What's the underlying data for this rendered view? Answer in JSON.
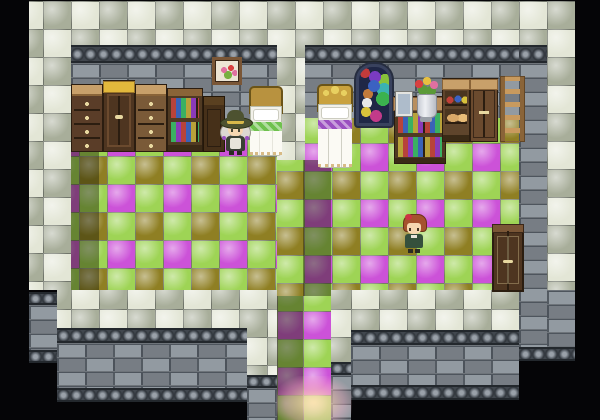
{
  "meta": {
    "title": "rpg-interior-map",
    "width": 600,
    "height": 420,
    "background": "#050507"
  },
  "palette": {
    "checker_light": "#e3e6d6",
    "checker_dark": "#a8ae9a",
    "grout": "#70756a",
    "floor_green": "#9ed455",
    "floor_magenta": "#cc52d8",
    "floor_olive": "#8f7f23",
    "brick": "#8a929a",
    "mortar": "#4e555d",
    "carved": "#41474e",
    "wood_dark": "#4e3520",
    "wood_mid": "#6b4a2e",
    "wood_tan": "#c8a06a",
    "yellow_top": "#e2b83c",
    "glow": "#ffdcaa",
    "book_colors": [
      "#b8433a",
      "#3a62b8",
      "#3ab062",
      "#b8a23a",
      "#8a3ab8"
    ],
    "jar_colors": [
      "#c04038",
      "#3b62c2",
      "#d8c23b"
    ],
    "window_colors": [
      "#c23b3b",
      "#3b62c2",
      "#3bb24e",
      "#d8c23b",
      "#7a3bc2",
      "#3bb2b2",
      "#e8e8e8",
      "#c23b8a",
      "#88c23b",
      "#c27a3b"
    ]
  },
  "regions": [
    {
      "name": "border-top-checker",
      "pattern": "checker",
      "x": 29,
      "y": 1,
      "w": 546,
      "h": 44,
      "ph": [
        42,
        0
      ],
      "interactable": false
    },
    {
      "name": "border-left-checker",
      "pattern": "checker",
      "x": 29,
      "y": 45,
      "w": 42,
      "h": 245,
      "ph": [
        42,
        12
      ],
      "interactable": false
    },
    {
      "name": "border-right-checker",
      "pattern": "checker",
      "x": 547,
      "y": 45,
      "w": 28,
      "h": 245,
      "ph": [
        28,
        12
      ],
      "interactable": false
    },
    {
      "name": "wall-cap-left-room",
      "pattern": "carved",
      "x": 71,
      "y": 45,
      "w": 206,
      "h": 18,
      "interactable": false
    },
    {
      "name": "wall-cap-right-room",
      "pattern": "carved",
      "x": 303,
      "y": 45,
      "w": 216,
      "h": 18,
      "interactable": false
    },
    {
      "name": "wall-cap-east",
      "pattern": "carved",
      "x": 519,
      "y": 45,
      "w": 28,
      "h": 18,
      "interactable": false
    },
    {
      "name": "wall-brick-left-room",
      "pattern": "brick",
      "x": 71,
      "y": 63,
      "w": 206,
      "h": 77,
      "interactable": false
    },
    {
      "name": "wall-brick-right-room",
      "pattern": "brick",
      "x": 303,
      "y": 63,
      "w": 216,
      "h": 55,
      "interactable": false
    },
    {
      "name": "wall-brick-east",
      "pattern": "brick",
      "x": 519,
      "y": 63,
      "w": 28,
      "h": 284,
      "interactable": false
    },
    {
      "name": "floor-left-room",
      "pattern": "floor",
      "x": 71,
      "y": 140,
      "w": 206,
      "h": 156,
      "ph": [
        36,
        44
      ],
      "interactable": true
    },
    {
      "name": "floor-left-wall-shadow",
      "pattern": "shade",
      "x": 71,
      "y": 140,
      "w": 28,
      "h": 156,
      "interactable": false
    },
    {
      "name": "floor-right-room",
      "pattern": "floor",
      "x": 277,
      "y": 118,
      "w": 242,
      "h": 178,
      "ph": [
        27,
        25
      ],
      "interactable": true
    },
    {
      "name": "floor-right-wall-shadow",
      "pattern": "shade",
      "x": 303,
      "y": 160,
      "w": 28,
      "h": 136,
      "interactable": false
    },
    {
      "name": "divider-wall-checker",
      "pattern": "checker",
      "x": 277,
      "y": 45,
      "w": 28,
      "h": 115,
      "ph": [
        18,
        12
      ],
      "interactable": false
    },
    {
      "name": "corridor-floor-shadowed",
      "pattern": "floor",
      "x": 277,
      "y": 296,
      "w": 26,
      "h": 124,
      "ph": [
        0,
        15
      ],
      "interactable": true
    },
    {
      "name": "corridor-shadow-overlay",
      "pattern": "shade",
      "x": 277,
      "y": 296,
      "w": 26,
      "h": 124,
      "interactable": false
    },
    {
      "name": "corridor-floor-bright",
      "pattern": "floor",
      "x": 303,
      "y": 296,
      "w": 28,
      "h": 124,
      "ph": [
        0,
        15
      ],
      "interactable": true
    },
    {
      "name": "walkway-left-checker",
      "pattern": "checker",
      "x": 57,
      "y": 290,
      "w": 190,
      "h": 38,
      "ph": [
        14,
        47
      ],
      "interactable": false
    },
    {
      "name": "walkway-ext-checker",
      "pattern": "checker",
      "x": 247,
      "y": 290,
      "w": 30,
      "h": 85,
      "ph": [
        48,
        47
      ],
      "interactable": false
    },
    {
      "name": "walkway-col-checker",
      "pattern": "checker",
      "x": 331,
      "y": 290,
      "w": 20,
      "h": 72,
      "ph": [
        20,
        47
      ],
      "interactable": false
    },
    {
      "name": "walkway-right-checker",
      "pattern": "checker",
      "x": 351,
      "y": 290,
      "w": 168,
      "h": 40,
      "ph": [
        0,
        47
      ],
      "interactable": false
    },
    {
      "name": "south-wall-a-cap",
      "pattern": "carved",
      "x": 29,
      "y": 292,
      "w": 28,
      "h": 13,
      "interactable": false
    },
    {
      "name": "south-wall-a-brick",
      "pattern": "brick",
      "x": 29,
      "y": 305,
      "w": 28,
      "h": 45,
      "interactable": false
    },
    {
      "name": "south-wall-a-foot",
      "pattern": "carved",
      "x": 29,
      "y": 350,
      "w": 28,
      "h": 13,
      "interactable": false
    },
    {
      "name": "south-wall-b-cap",
      "pattern": "carved",
      "x": 57,
      "y": 328,
      "w": 190,
      "h": 15,
      "interactable": false
    },
    {
      "name": "south-wall-b-brick",
      "pattern": "brick",
      "x": 57,
      "y": 343,
      "w": 190,
      "h": 45,
      "interactable": false
    },
    {
      "name": "south-wall-b-foot",
      "pattern": "carved",
      "x": 57,
      "y": 388,
      "w": 190,
      "h": 14,
      "interactable": false
    },
    {
      "name": "south-wall-c-cap",
      "pattern": "carved",
      "x": 247,
      "y": 375,
      "w": 30,
      "h": 13,
      "interactable": false
    },
    {
      "name": "south-wall-c-brick",
      "pattern": "brick",
      "x": 247,
      "y": 388,
      "w": 30,
      "h": 32,
      "interactable": false
    },
    {
      "name": "south-wall-d-cap",
      "pattern": "carved",
      "x": 331,
      "y": 362,
      "w": 20,
      "h": 13,
      "interactable": false
    },
    {
      "name": "south-wall-d-brick",
      "pattern": "brick",
      "x": 331,
      "y": 375,
      "w": 20,
      "h": 45,
      "interactable": false
    },
    {
      "name": "south-wall-e-cap",
      "pattern": "carved",
      "x": 351,
      "y": 330,
      "w": 168,
      "h": 15,
      "interactable": false
    },
    {
      "name": "south-wall-e-brick",
      "pattern": "brick",
      "x": 351,
      "y": 345,
      "w": 168,
      "h": 40,
      "interactable": false
    },
    {
      "name": "south-wall-e-foot",
      "pattern": "carved",
      "x": 351,
      "y": 385,
      "w": 168,
      "h": 15,
      "interactable": false
    },
    {
      "name": "south-wall-f-brick",
      "pattern": "brick",
      "x": 547,
      "y": 290,
      "w": 28,
      "h": 57,
      "interactable": false
    },
    {
      "name": "south-wall-f-foot",
      "pattern": "carved",
      "x": 519,
      "y": 347,
      "w": 56,
      "h": 14,
      "interactable": false
    },
    {
      "name": "exit-light-glow",
      "pattern": "glow",
      "x": 276,
      "y": 376,
      "w": 76,
      "h": 44,
      "interactable": false
    }
  ],
  "sprites": [
    {
      "name": "wall-picture-flowers",
      "kind": "frame",
      "x": 212,
      "y": 57,
      "w": 30,
      "h": 28,
      "interactable": false
    },
    {
      "name": "stained-glass-window",
      "kind": "window",
      "x": 356,
      "y": 64,
      "w": 36,
      "h": 62,
      "interactable": false
    },
    {
      "name": "dresser-left-1",
      "kind": "dresser",
      "x": 71,
      "y": 84,
      "w": 32,
      "h": 68,
      "top": "#c8a06a",
      "body": "#5a3d28",
      "interactable": false
    },
    {
      "name": "cupboard-yellow-top",
      "kind": "cupboard",
      "x": 103,
      "y": 80,
      "w": 32,
      "h": 72,
      "top": "#e2b83c",
      "body": "#4e3520",
      "interactable": false
    },
    {
      "name": "dresser-left-2",
      "kind": "dresser",
      "x": 135,
      "y": 84,
      "w": 32,
      "h": 68,
      "top": "#c8a06a",
      "body": "#7a5a38",
      "interactable": false
    },
    {
      "name": "bookshelf-left",
      "kind": "bookshelf",
      "x": 167,
      "y": 88,
      "w": 36,
      "h": 64,
      "interactable": false
    },
    {
      "name": "dark-chest",
      "kind": "chest",
      "x": 203,
      "y": 96,
      "w": 22,
      "h": 56,
      "interactable": false
    },
    {
      "name": "bed-left",
      "kind": "bed",
      "x": 249,
      "y": 86,
      "w": 34,
      "h": 70,
      "hb": "#b8923f",
      "trim": "#6fc14e",
      "crown": false,
      "interactable": false
    },
    {
      "name": "bed-right",
      "kind": "bed",
      "x": 317,
      "y": 84,
      "w": 36,
      "h": 84,
      "hb": "#c9a23f",
      "trim": "#9a4fc0",
      "crown": true,
      "interactable": false
    },
    {
      "name": "bookshelf-right-unit",
      "kind": "shelfunit",
      "x": 394,
      "y": 96,
      "w": 52,
      "h": 68,
      "interactable": false
    },
    {
      "name": "small-photo-frame",
      "kind": "smallframe",
      "x": 396,
      "y": 92,
      "w": 16,
      "h": 24,
      "interactable": false
    },
    {
      "name": "flower-vase",
      "kind": "vase",
      "x": 412,
      "y": 76,
      "w": 28,
      "h": 46,
      "interactable": false
    },
    {
      "name": "jar-shelf",
      "kind": "jarshelf",
      "x": 442,
      "y": 78,
      "w": 28,
      "h": 64,
      "interactable": false
    },
    {
      "name": "wardrobe",
      "kind": "wardrobe",
      "x": 470,
      "y": 78,
      "w": 28,
      "h": 64,
      "interactable": false
    },
    {
      "name": "wall-ladder",
      "kind": "ladder",
      "x": 500,
      "y": 76,
      "w": 25,
      "h": 66,
      "interactable": false
    },
    {
      "name": "door-right-room",
      "kind": "door",
      "x": 492,
      "y": 224,
      "w": 32,
      "h": 68,
      "interactable": true
    },
    {
      "name": "character-girl-hat",
      "kind": "girl",
      "x": 220,
      "y": 110,
      "w": 31,
      "h": 46,
      "interactable": true
    },
    {
      "name": "character-red-hair",
      "kind": "boy",
      "x": 402,
      "y": 214,
      "w": 24,
      "h": 40,
      "interactable": true
    }
  ],
  "characters": {
    "girl": {
      "hat": "#4d5230",
      "hat_band": "#d8b84a",
      "hair": "#dcd8d2",
      "skin": "#f6d7b0",
      "dress": "#3a4034",
      "apron": "#e8e4da",
      "tie": "#9a4fc0"
    },
    "boy": {
      "hair": "#a5522e",
      "bow": "#cc3344",
      "skin": "#f6d7b0",
      "shirt": "#35503c"
    }
  }
}
